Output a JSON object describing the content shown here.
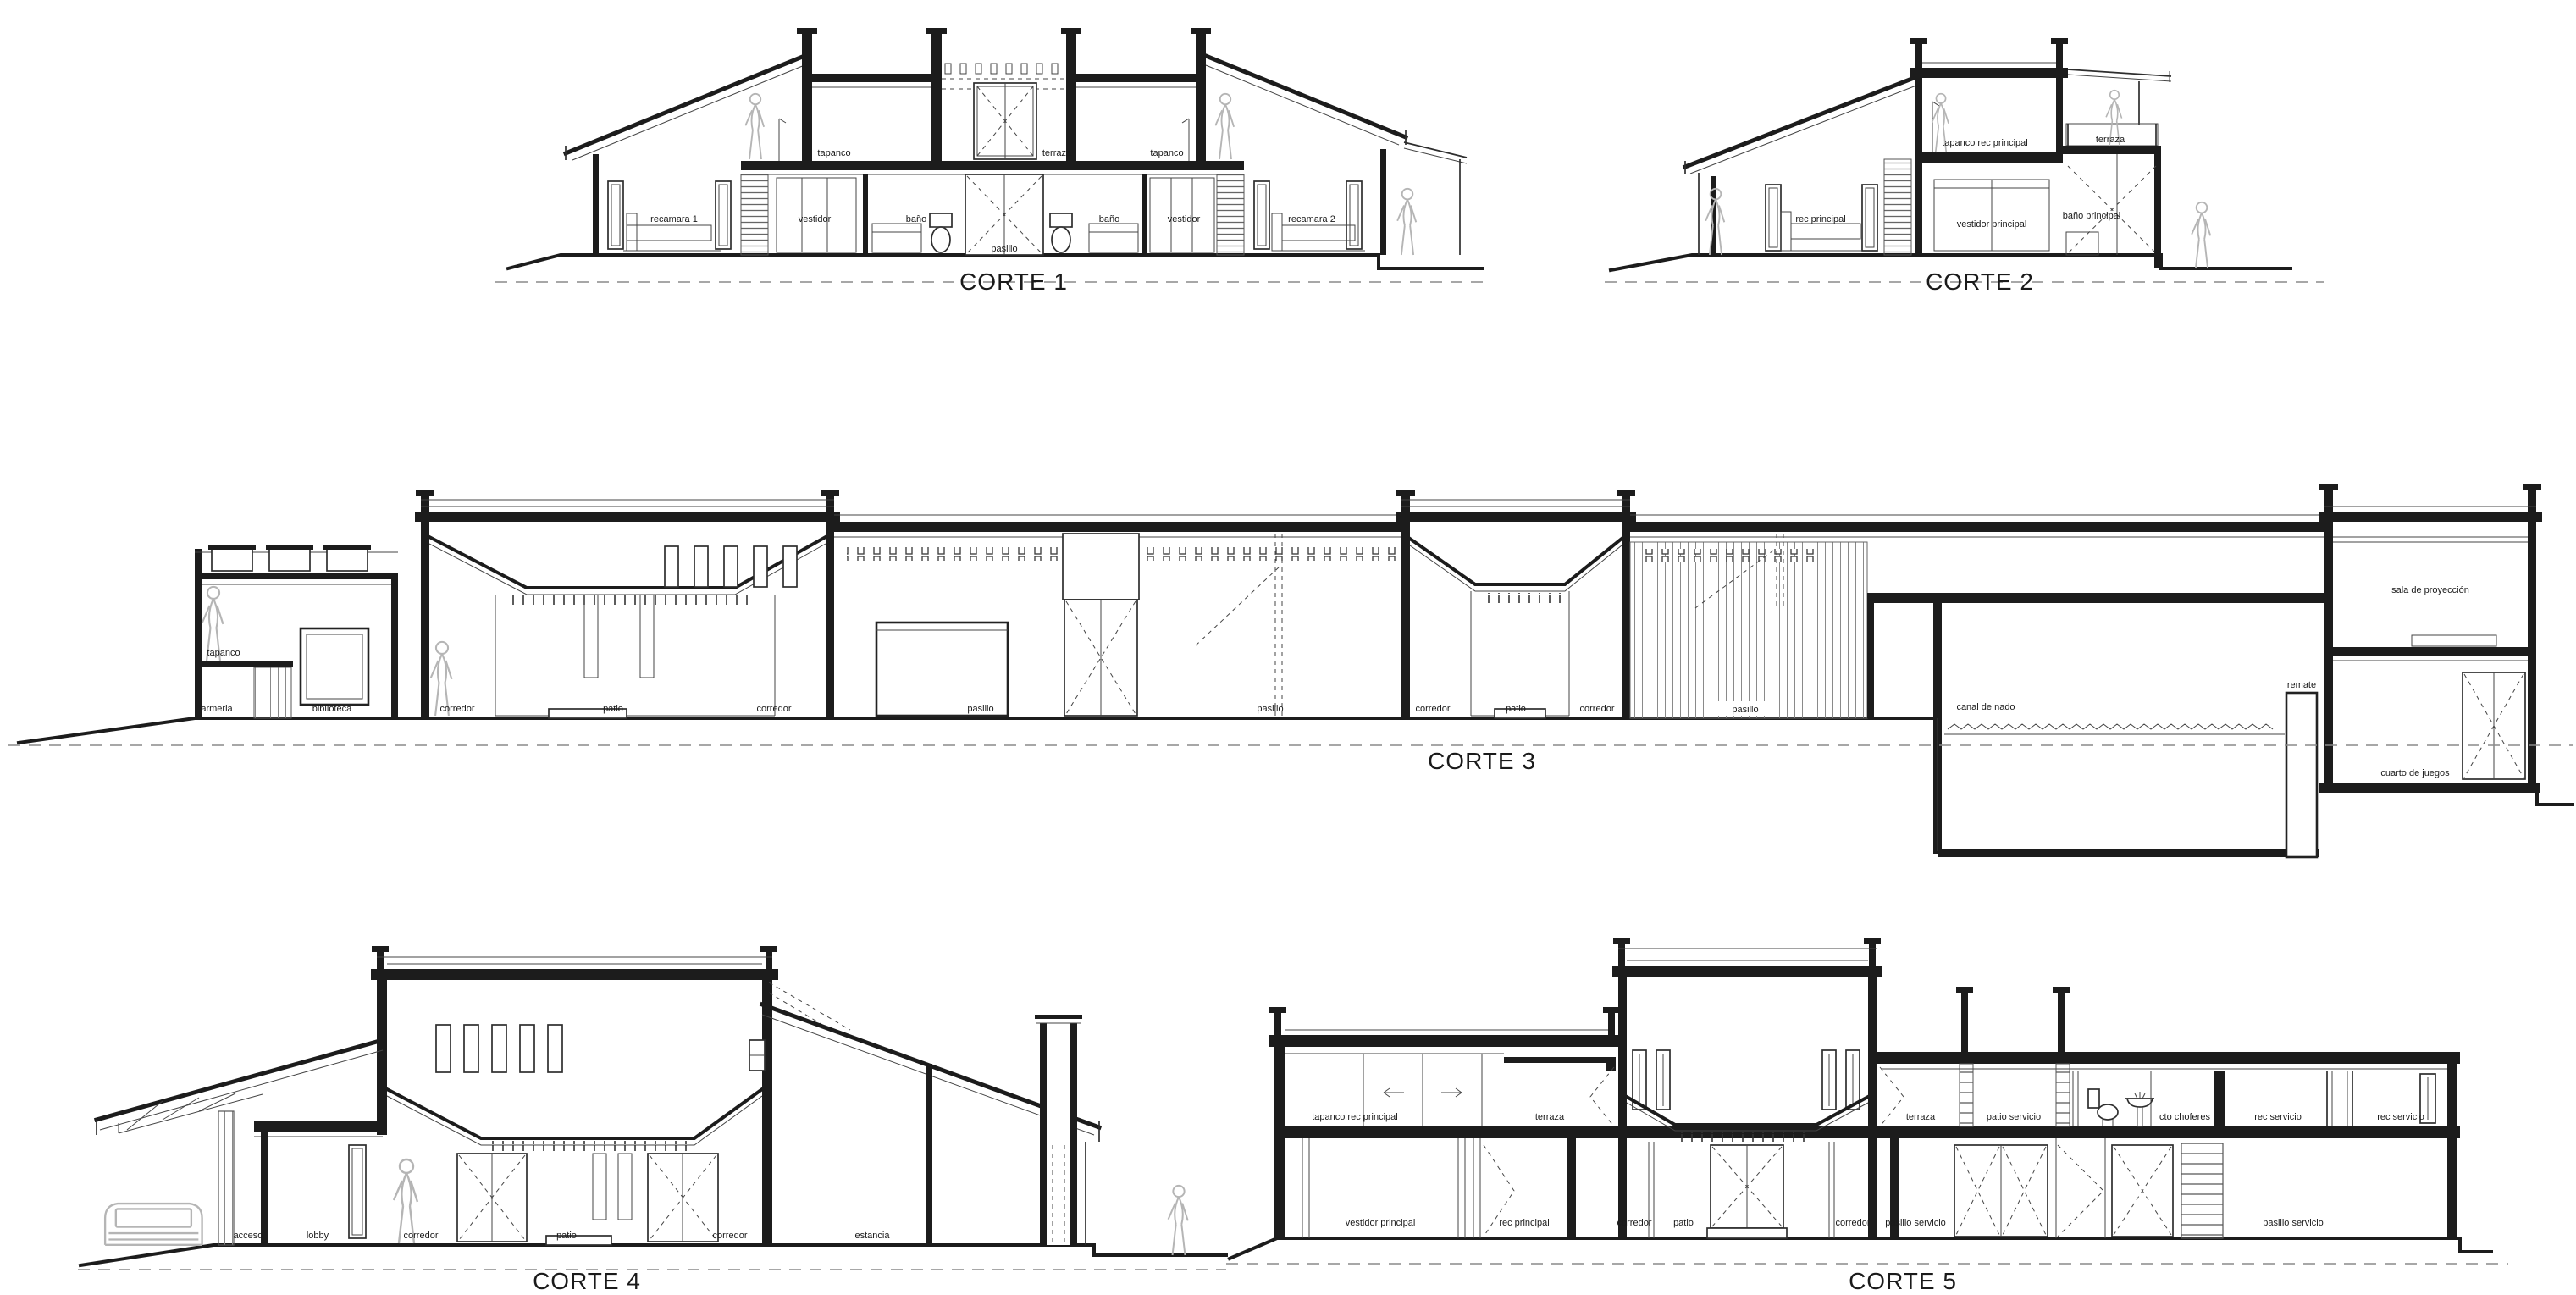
{
  "meta": {
    "drawing_type": "architectural building sections (cortes)",
    "background_color": "#ffffff",
    "line_color": "#1c1c1c",
    "light_line_color": "#8a8a8a",
    "figure_color": "#b5b5b5"
  },
  "sections": {
    "corte1": {
      "title": "CORTE 1",
      "labels": {
        "tapanco_left": "tapanco",
        "terraza": "terraza",
        "tapanco_right": "tapanco",
        "recamara_1": "recamara 1",
        "vestidor_left": "vestidor",
        "bano_left": "baño",
        "pasillo": "pasillo",
        "bano_right": "baño",
        "vestidor_right": "vestidor",
        "recamara_2": "recamara 2"
      }
    },
    "corte2": {
      "title": "CORTE 2",
      "labels": {
        "tapanco_rec_principal": "tapanco rec principal",
        "terraza": "terraza",
        "rec_principal": "rec principal",
        "vestidor_principal": "vestidor principal",
        "bano_principal": "baño principal"
      }
    },
    "corte3": {
      "title": "CORTE 3",
      "labels": {
        "tapanco": "tapanco",
        "armeria": "armeria",
        "biblioteca": "biblioteca",
        "corredor_1": "corredor",
        "patio_1": "patio",
        "corredor_2": "corredor",
        "pasillo_1": "pasillo",
        "pasillo_2": "pasillo",
        "corredor_3": "corredor",
        "patio_2": "patio",
        "corredor_4": "corredor",
        "pasillo_3": "pasillo",
        "canal_de_nado": "canal de nado",
        "remate": "remate",
        "sala_de_proyeccion": "sala de proyección",
        "cuarto_de_juegos": "cuarto de juegos"
      }
    },
    "corte4": {
      "title": "CORTE 4",
      "labels": {
        "acceso": "acceso",
        "lobby": "lobby",
        "corredor_1": "corredor",
        "patio": "patio",
        "corredor_2": "corredor",
        "estancia": "estancia"
      }
    },
    "corte5": {
      "title": "CORTE 5",
      "labels": {
        "tapanco_rec_principal": "tapanco rec principal",
        "terraza_1": "terraza",
        "terraza_2": "terraza",
        "patio_servicio": "patio servicio",
        "cto_choferes": "cto choferes",
        "rec_servicio_1": "rec servicio",
        "rec_servicio_2": "rec servicio",
        "vestidor_principal": "vestidor principal",
        "rec_principal": "rec principal",
        "corredor_1": "corredor",
        "patio": "patio",
        "corredor_2": "corredor",
        "pasillo_servicio_1": "pasillo servicio",
        "pasillo_servicio_2": "pasillo servicio"
      }
    }
  }
}
